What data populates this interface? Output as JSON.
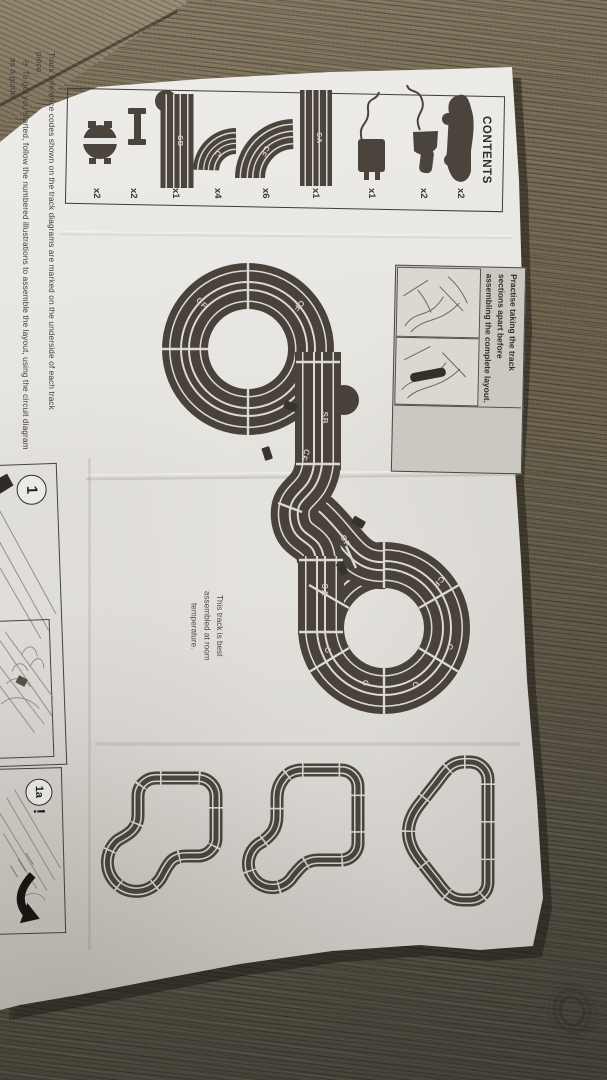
{
  "scene": {
    "description": "Slot-car racing set instruction leaflet photographed on a wooden table, sheet rotated 90 degrees clockwise"
  },
  "contents_panel": {
    "title": "CONTENTS",
    "items": [
      {
        "name": "slot-car",
        "qty": "x2"
      },
      {
        "name": "hand-controller",
        "qty": "x2"
      },
      {
        "name": "power-supply-plug",
        "qty": "x1"
      },
      {
        "name": "standard-straight",
        "code": "SA",
        "qty": "x1"
      },
      {
        "name": "outer-curve",
        "code": "CF",
        "qty": "x6"
      },
      {
        "name": "inner-curve",
        "code": "C",
        "qty": "x4"
      },
      {
        "name": "powerbase-straight",
        "code": "SB",
        "qty": "x1"
      },
      {
        "name": "track-clip",
        "qty": "x2"
      },
      {
        "name": "guide-accessory",
        "qty": "x2"
      }
    ]
  },
  "notes": {
    "reference": "Track reference codes shown on the track diagrams are marked on the underside of each track piece.",
    "get_started": "① To get you started, follow the numbered illustrations to assemble the layout, using the circuit diagram as a guide.",
    "practise": "Practise taking the track sections apart before assembling the complete layout.",
    "temperature": "This track is best assembled at room temperature."
  },
  "diagram": {
    "labels": {
      "cf": "CF",
      "c": "C",
      "sa": "SA",
      "sb": "SB"
    }
  },
  "steps": {
    "step1_badge": "1",
    "step1a_badge": "1a",
    "alert": "!"
  },
  "colors": {
    "track_dark": "#48423a",
    "paper": "#e9e7e3",
    "wood": "#6e6450"
  }
}
